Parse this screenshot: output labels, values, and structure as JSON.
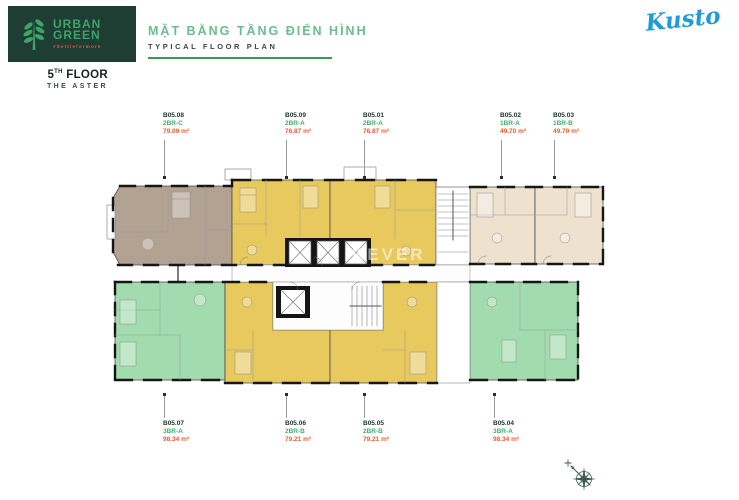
{
  "header": {
    "logo": {
      "line1": "URBAN",
      "line2": "GREEN",
      "tagline": "#Settleformore"
    },
    "floor_label": {
      "number": "5",
      "ordinal": "TH",
      "word": "FLOOR",
      "project": "THE ASTER"
    },
    "title_primary": "MẶT BẰNG TẦNG ĐIỂN HÌNH",
    "title_secondary": "TYPICAL FLOOR PLAN",
    "brand_logo": "Kusto"
  },
  "palette": {
    "brand_dark_green": "#1e3d33",
    "logo_green": "#3fa368",
    "accent_orange": "#f15b2e",
    "title_green": "#6cbc8f",
    "underline_green": "#2f9e57",
    "kusto_blue": "#1e9cd8",
    "unit_number_color": "#21352e",
    "unit_type_color": "#3fae6e",
    "unit_area_color": "#f15b2e",
    "tan": "#b2a292",
    "yellow": "#e8c95e",
    "green": "#a2dcae",
    "cream": "#eee2cf",
    "wall": "#161616",
    "compass_color": "#3a5c4e"
  },
  "plan": {
    "watermark": "REVER",
    "units": [
      {
        "id": "B05.08",
        "type": "2BR-C",
        "area": "79.09 m²",
        "side": "top",
        "label_x": 163,
        "color_key": "tan"
      },
      {
        "id": "B05.09",
        "type": "2BR-A",
        "area": "76.87 m²",
        "side": "top",
        "label_x": 285,
        "color_key": "yellow"
      },
      {
        "id": "B05.01",
        "type": "2BR-A",
        "area": "76.87 m²",
        "side": "top",
        "label_x": 363,
        "color_key": "yellow"
      },
      {
        "id": "B05.02",
        "type": "1BR-A",
        "area": "49.70 m²",
        "side": "top",
        "label_x": 500,
        "color_key": "cream"
      },
      {
        "id": "B05.03",
        "type": "1BR-B",
        "area": "49.70 m²",
        "side": "top",
        "label_x": 553,
        "color_key": "cream"
      },
      {
        "id": "B05.07",
        "type": "3BR-A",
        "area": "98.34 m²",
        "side": "bottom",
        "label_x": 163,
        "color_key": "green"
      },
      {
        "id": "B05.06",
        "type": "2BR-B",
        "area": "79.21 m²",
        "side": "bottom",
        "label_x": 285,
        "color_key": "yellow"
      },
      {
        "id": "B05.05",
        "type": "2BR-B",
        "area": "79.21 m²",
        "side": "bottom",
        "label_x": 363,
        "color_key": "yellow"
      },
      {
        "id": "B05.04",
        "type": "3BR-A",
        "area": "98.34 m²",
        "side": "bottom",
        "label_x": 493,
        "color_key": "green"
      }
    ]
  }
}
